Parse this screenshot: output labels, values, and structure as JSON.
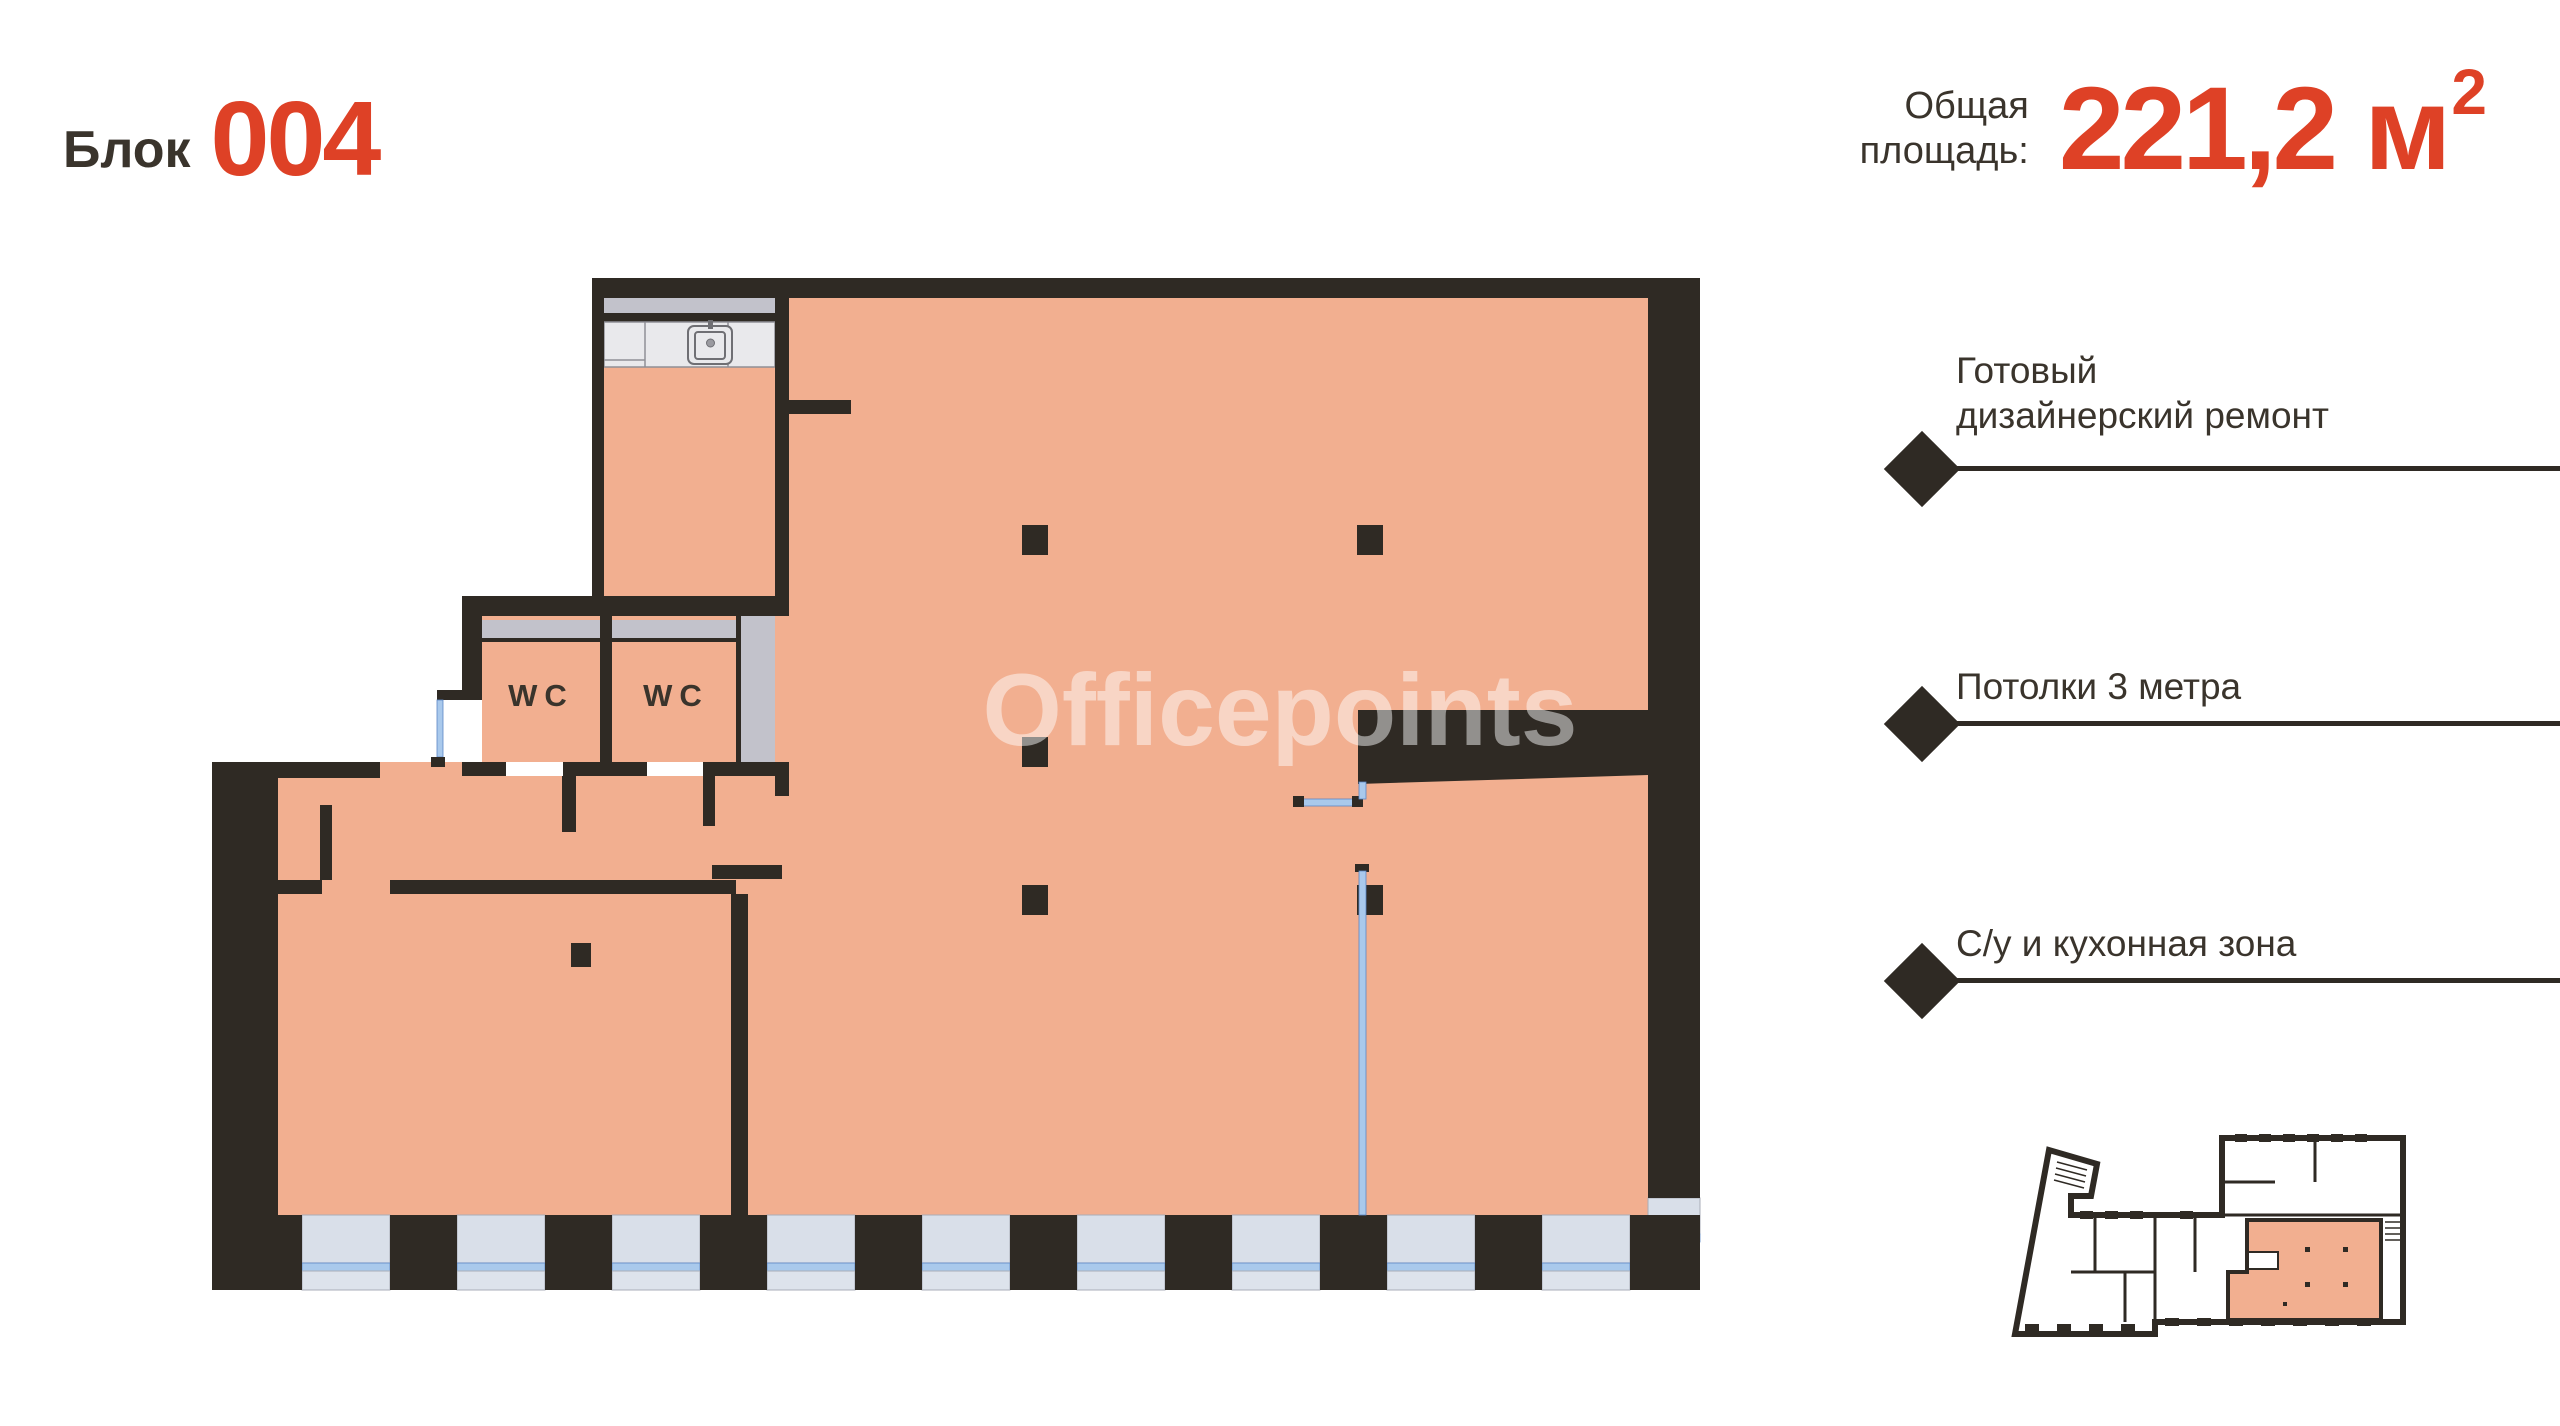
{
  "colors": {
    "accent_red": "#de4126",
    "wall_dark": "#2f2a24",
    "text_dark": "#3a342c",
    "floor_salmon": "#f2af90",
    "window_glass": "#d9dfe9",
    "window_sill_blue": "#a9c9ec",
    "counter_gray": "#e9e9ec",
    "duct_gray": "#c2c2cb"
  },
  "header": {
    "block_label": "Блок",
    "block_number": "004"
  },
  "area": {
    "label_line1": "Общая",
    "label_line2": "площадь:",
    "value": "221,2",
    "unit": "м",
    "superscript": "2"
  },
  "features": [
    {
      "line1": "Готовый",
      "line2": "дизайнерский ремонт"
    },
    {
      "line1": "Потолки 3 метра",
      "line2": ""
    },
    {
      "line1": "С/у и кухонная зона",
      "line2": ""
    }
  ],
  "plan": {
    "wc_label": "WC",
    "watermark": "Officepoints"
  }
}
